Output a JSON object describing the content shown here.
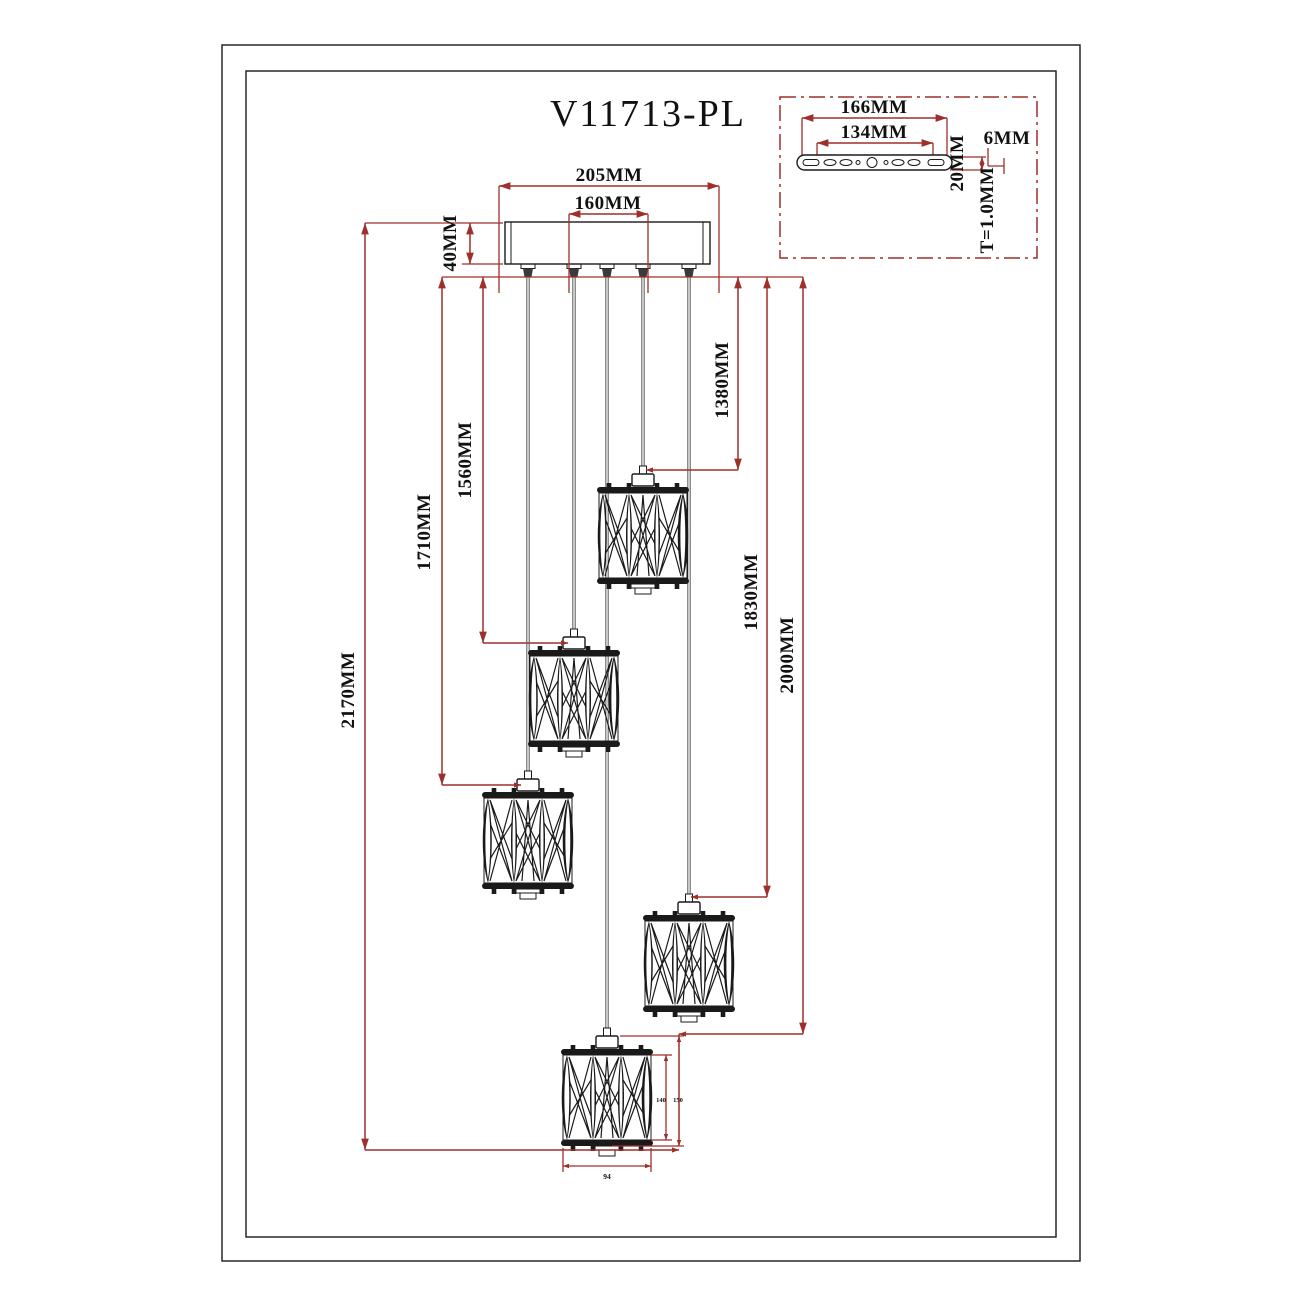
{
  "title": "V11713-PL",
  "colors": {
    "dimension_red": "#9e2f2a",
    "drawing_black": "#1a1a1a",
    "background": "#ffffff"
  },
  "main_view": {
    "pendant_count": 5,
    "dims": {
      "d205": "205MM",
      "d160": "160MM",
      "d40": "40MM",
      "d1380": "1380MM",
      "d1560": "1560MM",
      "d1710": "1710MM",
      "d1830": "1830MM",
      "d2000": "2000MM",
      "d2170": "2170MM",
      "d140": "140",
      "d150": "150",
      "d94": "94"
    }
  },
  "detail_view": {
    "dims": {
      "d166": "166MM",
      "d134": "134MM",
      "d20": "20MM",
      "d6": "6MM",
      "thickness": "T=1.0MM"
    }
  }
}
